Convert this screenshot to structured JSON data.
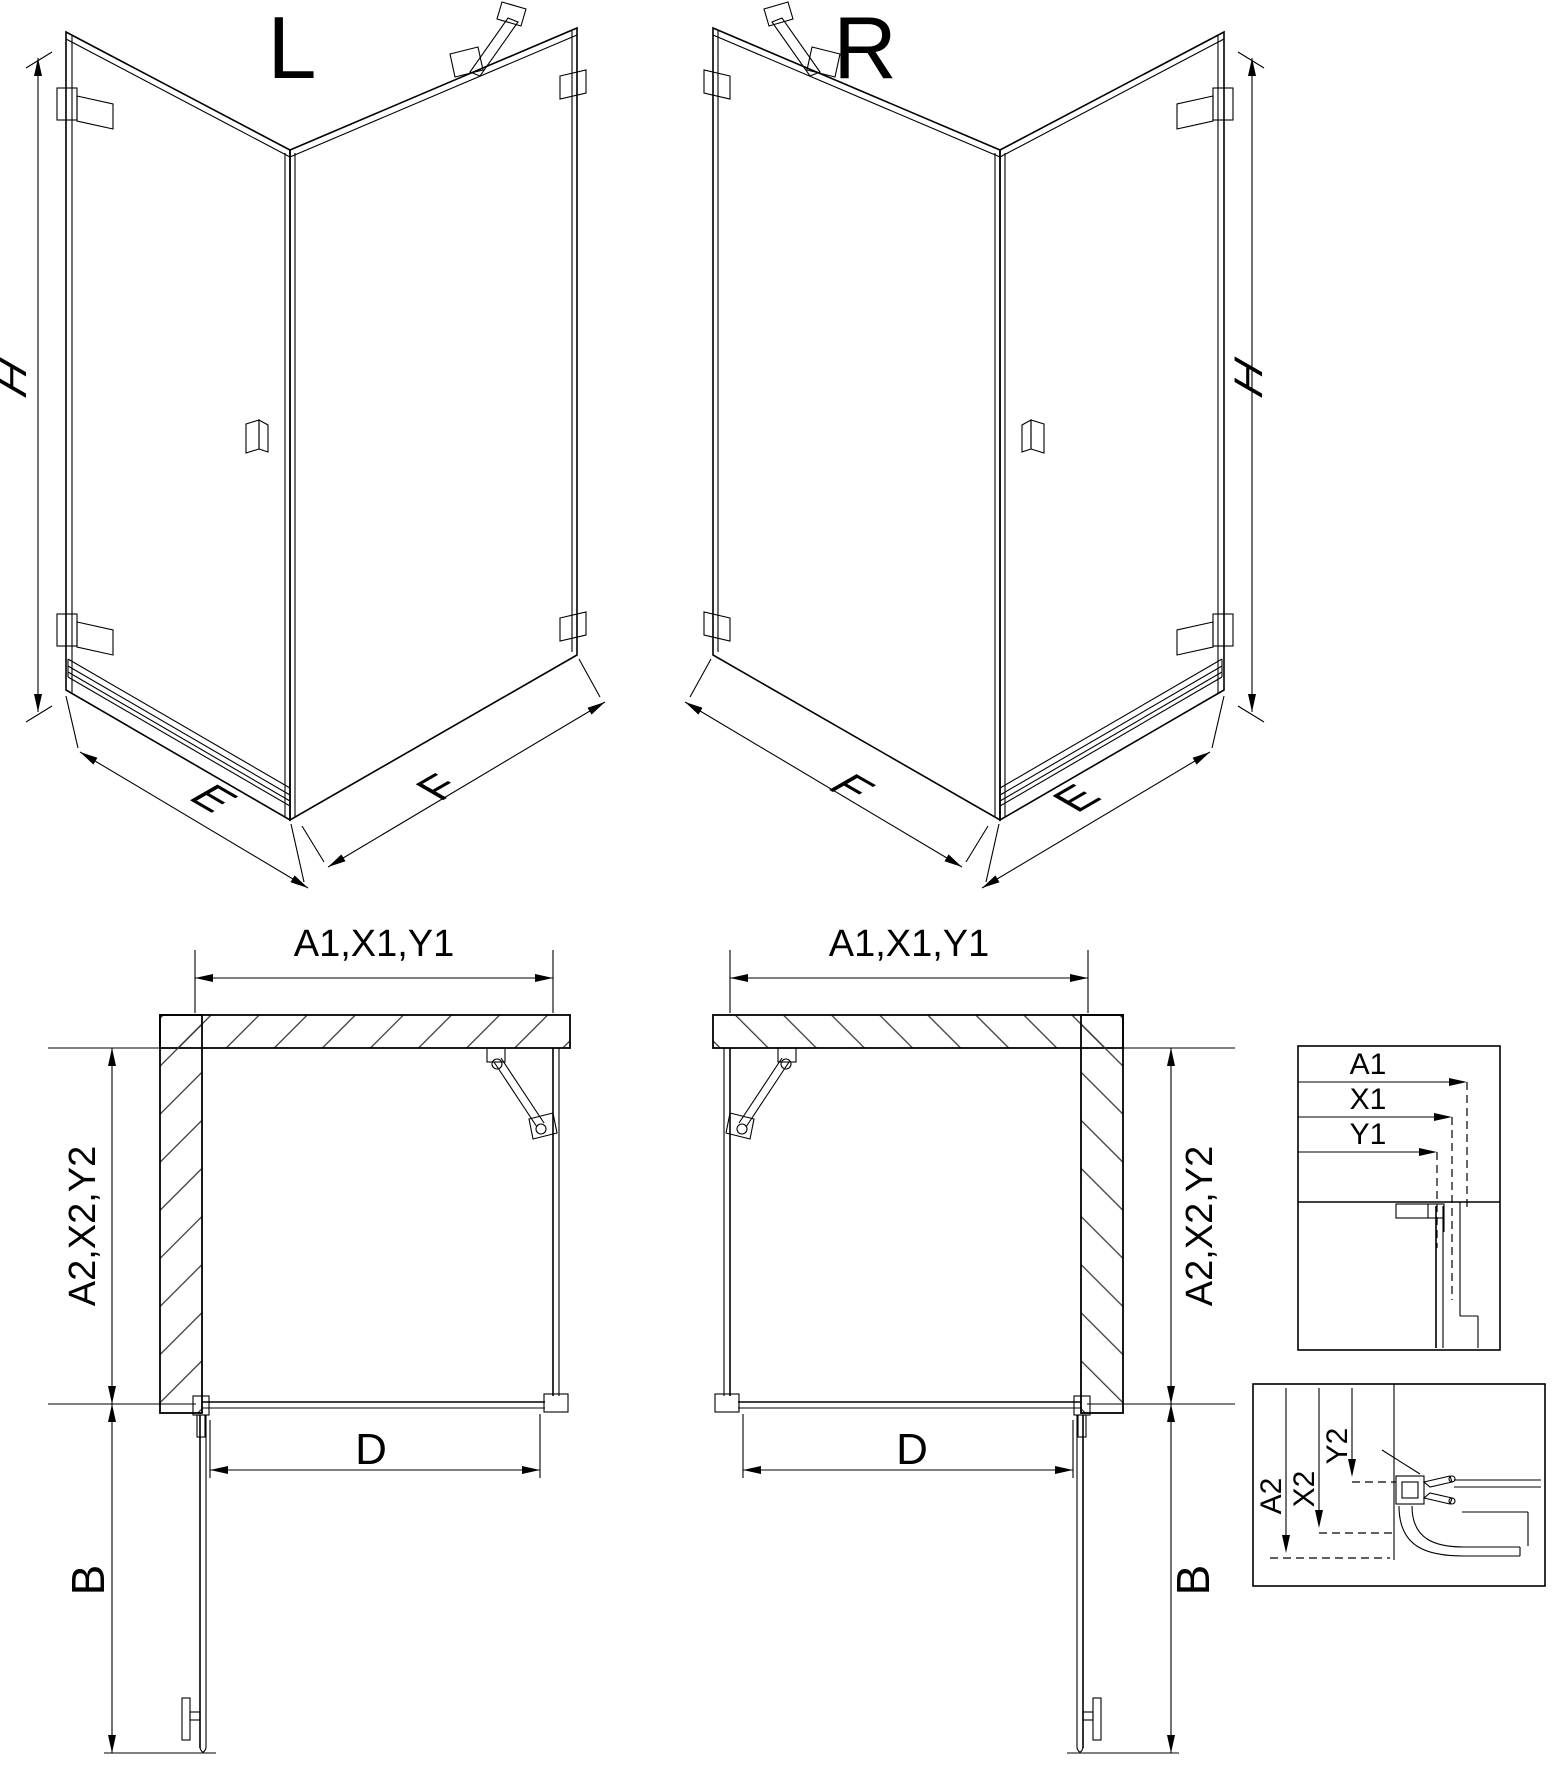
{
  "v3l": {
    "label": "L",
    "h": "H",
    "e": "E",
    "f": "F"
  },
  "v3r": {
    "label": "R",
    "h": "H",
    "e": "E",
    "f": "F"
  },
  "pl": {
    "a1": "A1,X1,Y1",
    "a2": "A2,X2,Y2",
    "d": "D",
    "b": "B"
  },
  "pr": {
    "a1": "A1,X1,Y1",
    "a2": "A2,X2,Y2",
    "d": "D",
    "b": "B"
  },
  "dt": {
    "a1": "A1",
    "x1": "X1",
    "y1": "Y1"
  },
  "db": {
    "a2": "A2",
    "x2": "X2",
    "y2": "Y2"
  }
}
